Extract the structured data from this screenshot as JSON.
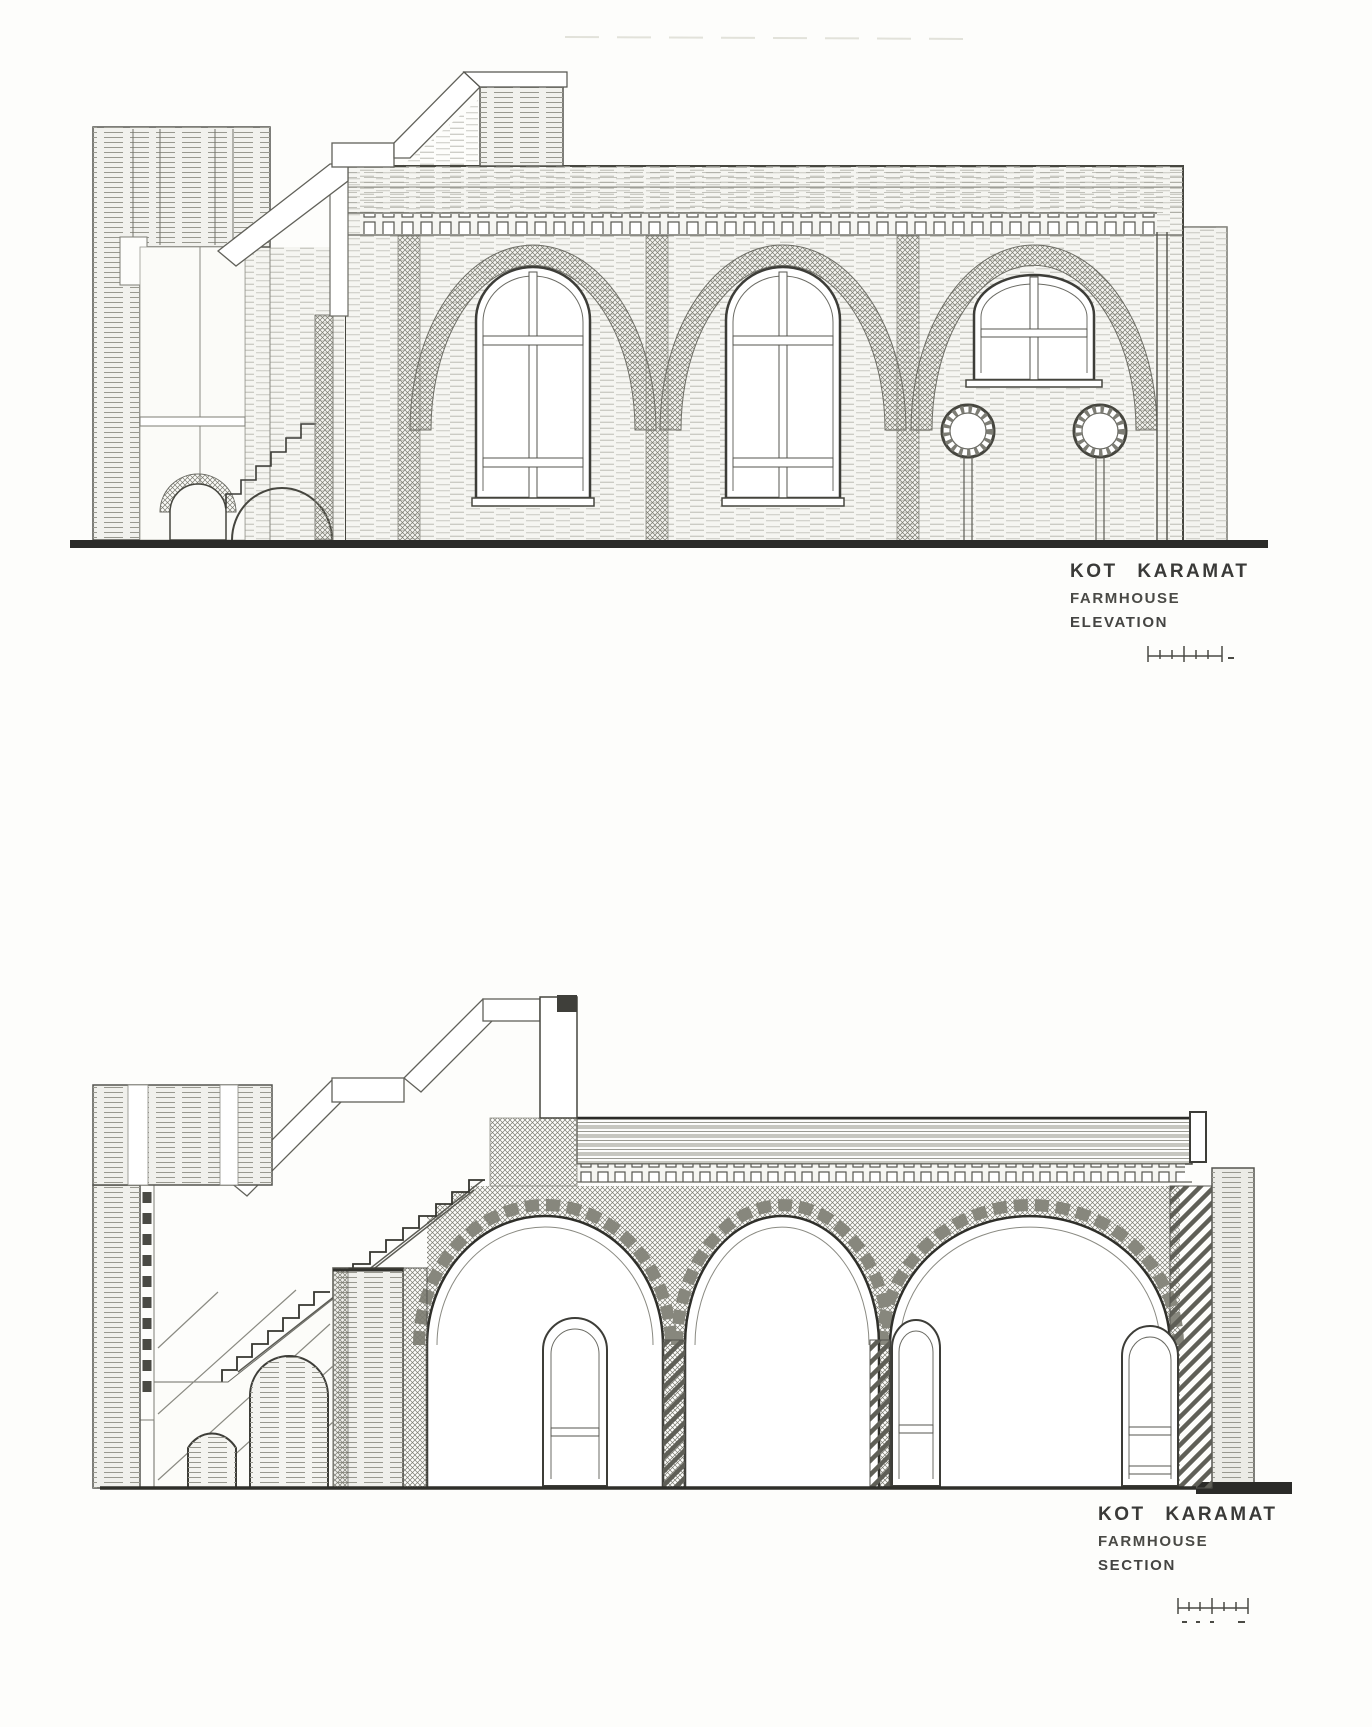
{
  "document": {
    "kind_label": "architectural drawing scan"
  },
  "colors": {
    "paper": "#fdfdfb",
    "ink": "#333330",
    "hatch_light": "#b0b0a8",
    "hatch_dark": "#8f8f87",
    "ground": "#2b2b28"
  },
  "elevation_label": {
    "project": "KOT KARAMAT",
    "building": "FARMHOUSE",
    "drawing_type": "ELEVATION"
  },
  "section_label": {
    "project": "KOT KARAMAT",
    "building": "FARMHOUSE",
    "drawing_type": "SECTION"
  }
}
